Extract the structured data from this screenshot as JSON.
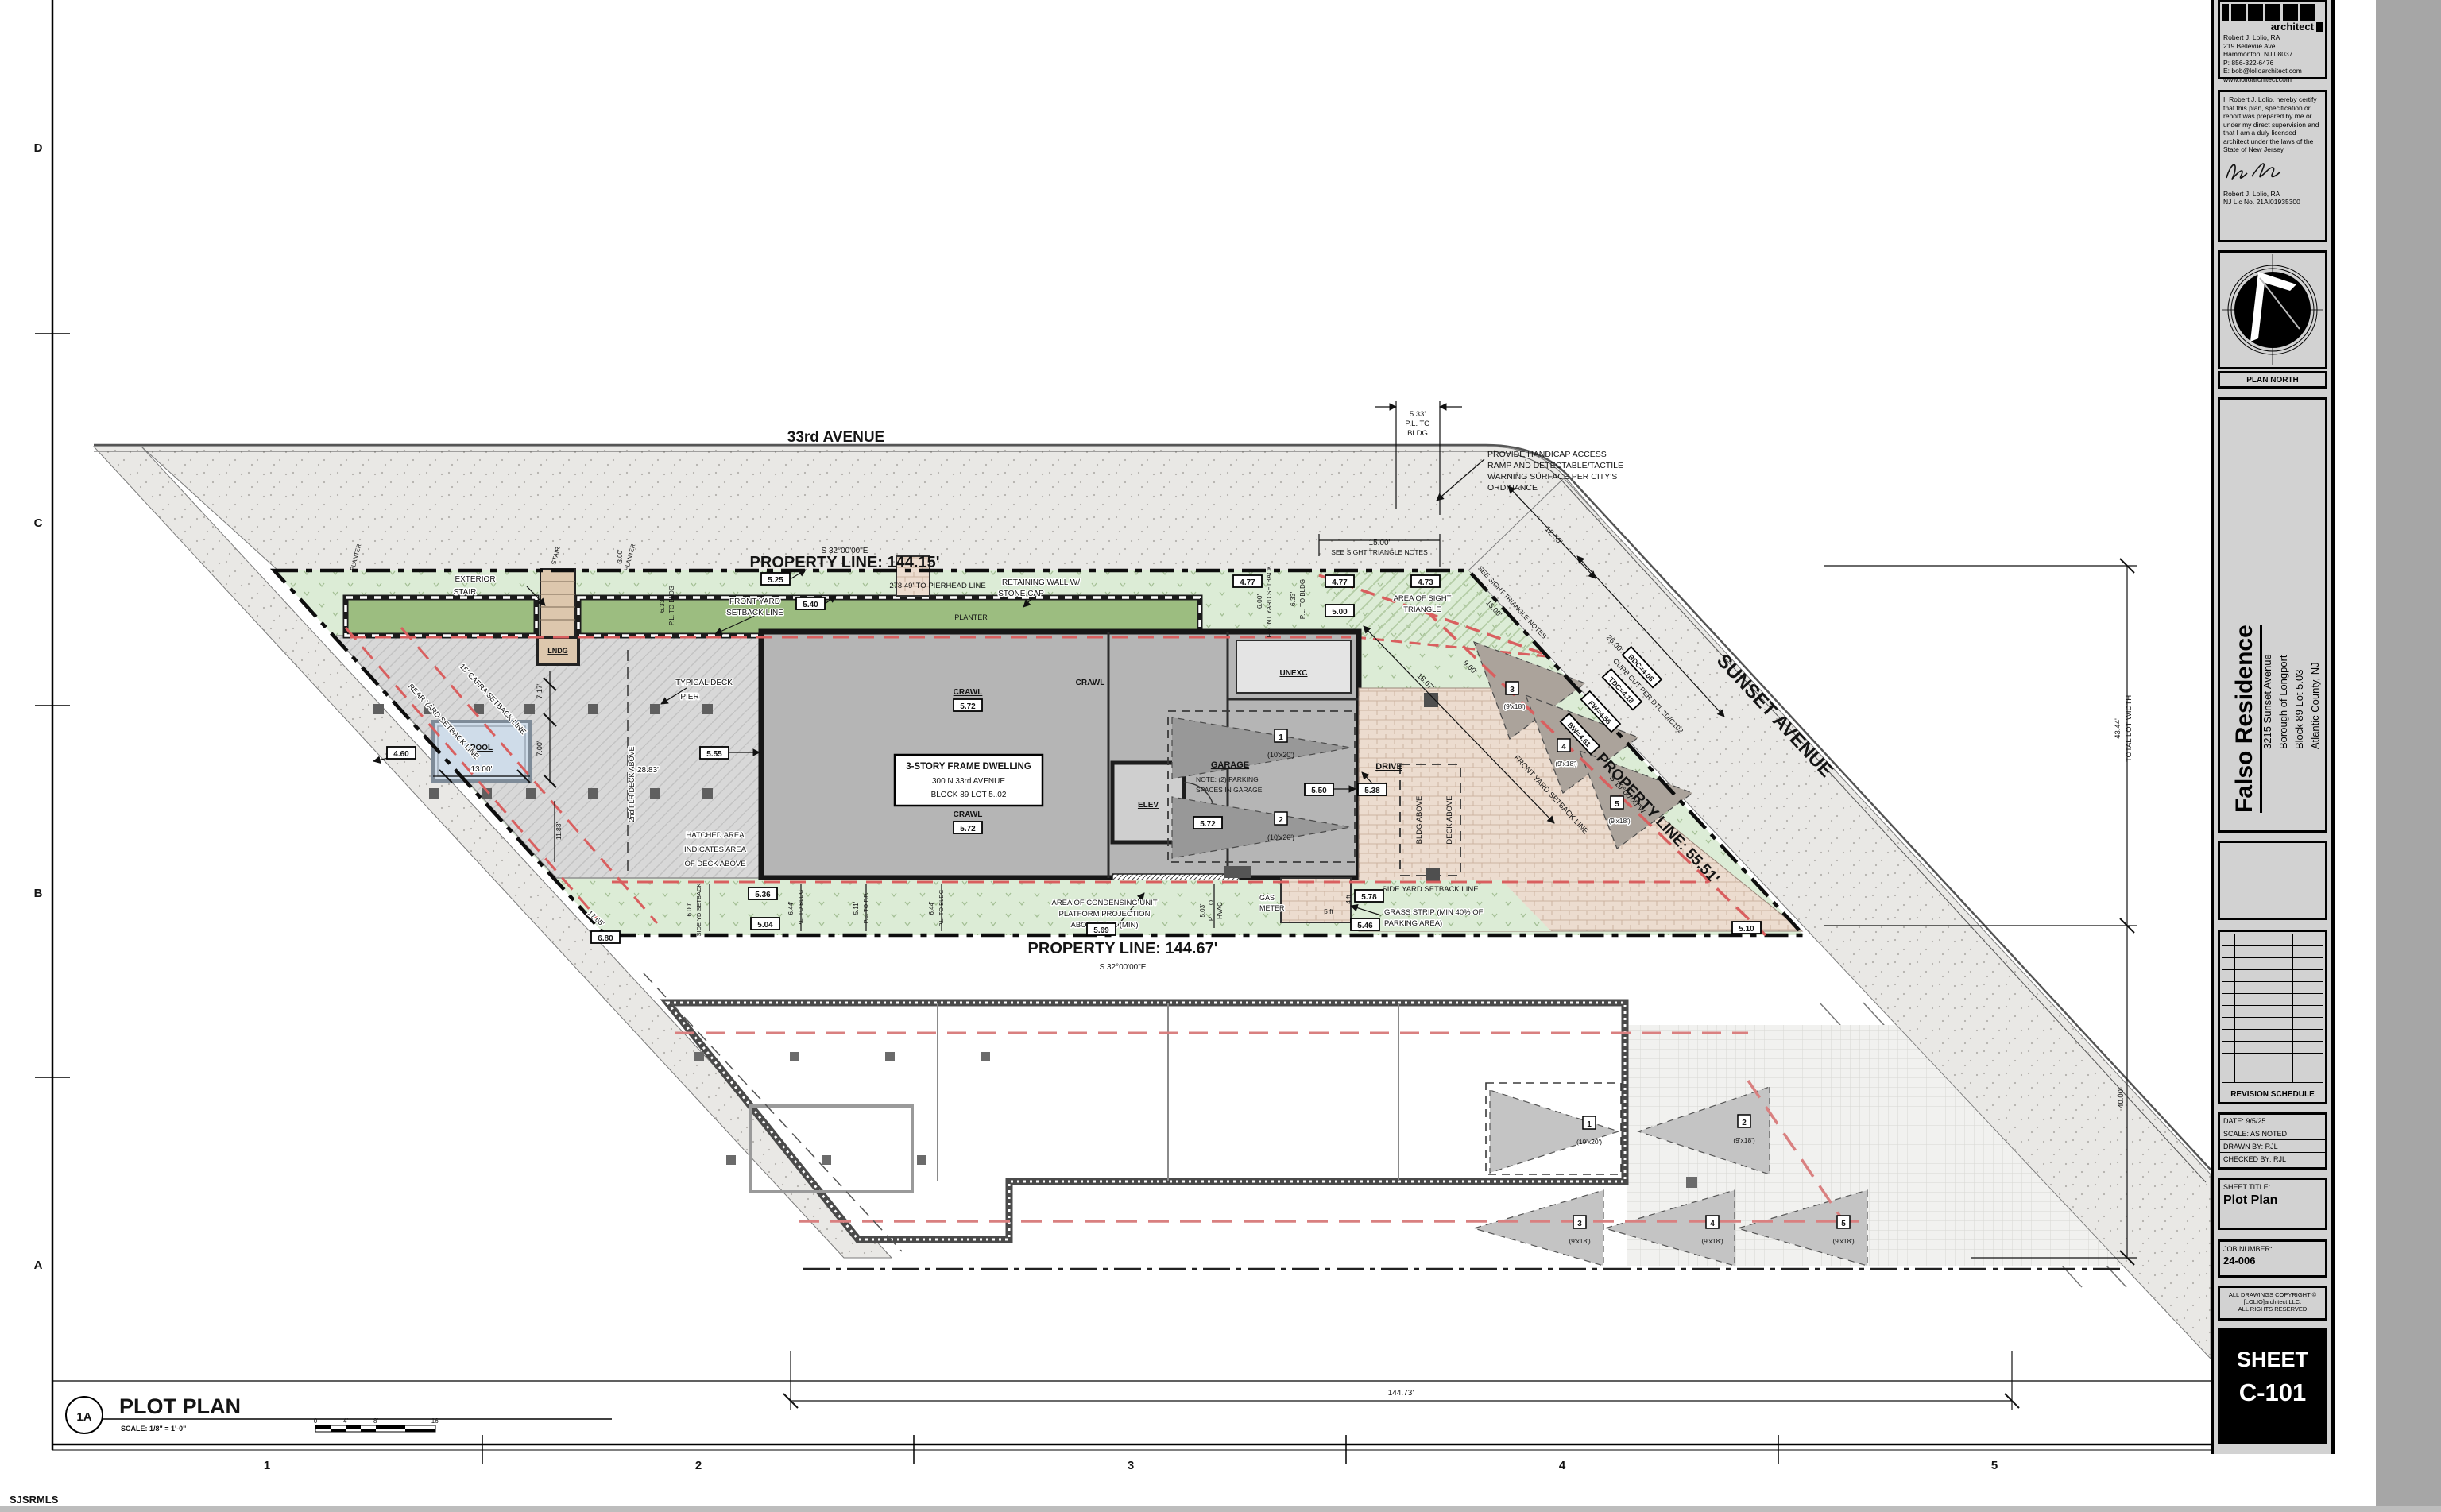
{
  "sheet": {
    "grid_letters": [
      "D",
      "C",
      "B",
      "A"
    ],
    "grid_numbers": [
      "1",
      "2",
      "3",
      "4",
      "5"
    ],
    "watermark": "SJSRMLS"
  },
  "viewport": {
    "id": "1A",
    "title": "PLOT PLAN",
    "scale": "SCALE: 1/8\"  =  1'-0\"",
    "bar": [
      "0",
      "4'",
      "8'",
      "16'"
    ]
  },
  "titleblock": {
    "logo_text": "architect",
    "firm": [
      "Robert J. Lolio, RA",
      "219 Bellevue Ave",
      "Hammonton, NJ 08037",
      "P: 856-322-6476",
      "E: bob@lolioarchitect.com",
      "www.lolioarchitect.com"
    ],
    "cert": [
      "I, Robert J. Lolio, hereby certify",
      "that this plan, specification or",
      "report was prepared by me or",
      "under my direct supervision and",
      "that I am a duly licensed",
      "architect under the laws of the",
      "State of New Jersey."
    ],
    "cert_name": "Robert J. Lolio, RA",
    "cert_lic": "NJ Lic No. 21AI01935300",
    "plan_north": "PLAN NORTH",
    "project_name": "Falso Residence",
    "project_addr": [
      "3215 Sunset Avenue",
      "Borough of Longport",
      "Block 89  Lot 5.03",
      "Atlantic County, NJ"
    ],
    "revision": "REVISION SCHEDULE",
    "date": "DATE: 9/5/25",
    "scale_noted": "SCALE: AS NOTED",
    "drawn": "DRAWN BY: RJL",
    "checked": "CHECKED BY: RJL",
    "sheet_title_label": "SHEET TITLE:",
    "sheet_title": "Plot Plan",
    "job_label": "JOB NUMBER:",
    "job_number": "24-006",
    "copyright": [
      "ALL DRAWINGS COPYRIGHT ©",
      "[LOLIO]architect LLC.",
      "ALL RIGHTS RESERVED"
    ],
    "sheet_word": "SHEET",
    "sheet_number": "C-101"
  },
  "plan": {
    "ave33": "33rd AVENUE",
    "sunset": "SUNSET AVENUE",
    "pl_top": "PROPERTY LINE: 144.15'",
    "pl_top_brg": "S 32°00'00\"E",
    "pl_bot": "PROPERTY LINE: 144.67'",
    "pl_bot_brg": "S 32°00'00\"E",
    "pl_right": "PROPERTY LINE: 55.51'",
    "pl_right_brg": "S 19°00'00\"W",
    "pierhead": "278.49' TO PIERHEAD LINE",
    "handicap": [
      "PROVIDE HANDICAP ACCESS",
      "RAMP AND DETECTABLE/TACTILE",
      "WARNING SURFACE PER CITY'S",
      "ORDINANCE"
    ],
    "d533": [
      "5.33'",
      "P.L. TO",
      "BLDG"
    ],
    "d1250": "12.50'",
    "d1500": "15.00'",
    "sight_note": "SEE SIGHT TRIANGLE NOTES",
    "area_sight": [
      "AREA OF SIGHT",
      "TRIANGLE"
    ],
    "curbcut": "CURB CUT PER DTL 2D/C102",
    "d2600": "26.00'",
    "fy": [
      "FRONT YARD",
      "SETBACK LINE"
    ],
    "fy_diag": "FRONT YARD SETBACK LINE",
    "retwall": [
      "RETAINING WALL W/",
      "STONE CAP"
    ],
    "planter": "PLANTER",
    "d300": "3.00'",
    "stair": "STAIR",
    "extstair": [
      "EXTERIOR",
      "STAIR"
    ],
    "lndg": "LNDG",
    "d633": "6.33'",
    "pl_to_bldg": "P.L. TO BLDG",
    "d600": "6.00'",
    "fy_sb": "FRONT YARD SETBACK",
    "b525": "5.25",
    "b540": "5.40",
    "b500": "5.00",
    "b477": "4.77",
    "b473": "4.73",
    "b460": "4.60",
    "b555": "5.55",
    "b550": "5.50",
    "b572": "5.72",
    "b538": "5.38",
    "b536": "5.36",
    "b504": "5.04",
    "b569": "5.69",
    "b546": "5.46",
    "b578": "5.78",
    "b510": "5.10",
    "b680": "6.80",
    "bw": "BW=4.61",
    "fwv": "FW=4.56",
    "tdc": "TDC=4.18",
    "bdc": "BDC=4.08",
    "dwelling": [
      "3-STORY FRAME DWELLING",
      "300 N 33rd AVENUE",
      "BLOCK 89  LOT 5..02"
    ],
    "crawl": "CRAWL",
    "unexc": "UNEXC",
    "elev": "ELEV",
    "garage": "GARAGE",
    "gnote": [
      "NOTE: (2) PARKING",
      "SPACES IN GARAGE"
    ],
    "n1": "1",
    "n2": "2",
    "n3": "3",
    "n4": "4",
    "n5": "5",
    "s1020": "(10'x20')",
    "s918": "(9'x18')",
    "drive": "DRIVE",
    "bldg_above": "BLDG ABOVE",
    "deck_above": "DECK ABOVE",
    "sideyard": "SIDE YARD SETBACK LINE",
    "sideyd": [
      "6.00'",
      "SIDE YD SETBACK"
    ],
    "grass": [
      "GRASS STRIP (MIN 40% OF",
      "PARKING AREA)"
    ],
    "cond": [
      "AREA OF CONDENSING UNIT",
      "PLATFORM PROJECTION",
      "ABOVE D.F.E (MIN)"
    ],
    "gas": [
      "GAS",
      "METER"
    ],
    "hvac": [
      "5.03'",
      "P.L. TO",
      "HVAC"
    ],
    "ft5": "5 ft",
    "ft4": "4 ft",
    "pier": [
      "TYPICAL DECK",
      "PIER"
    ],
    "hatched": [
      "HATCHED AREA",
      "INDICATES AREA",
      "OF DECK ABOVE"
    ],
    "deck2": "2nd FLR DECK ABOVE",
    "pool": "POOL",
    "d1300": "13.00'",
    "d717": "7.17'",
    "d700": "7.00'",
    "d2883": "28.83'",
    "d1183": "11.83'",
    "d1765": "17.65'",
    "cafra": "15' CAFRA SETBACK LINE",
    "rear": "REAR YARD SETBACK LINE",
    "d644": "6.44'",
    "pl_to_fp": "P.L. TO F.P.",
    "d511": "5.11'",
    "d4344": "43.44'",
    "tlw": "TOTAL LOT WIDTH",
    "d4000": "40.00'",
    "d14473": "144.73'",
    "d1867": "18.67'",
    "d960": "9.60'"
  }
}
